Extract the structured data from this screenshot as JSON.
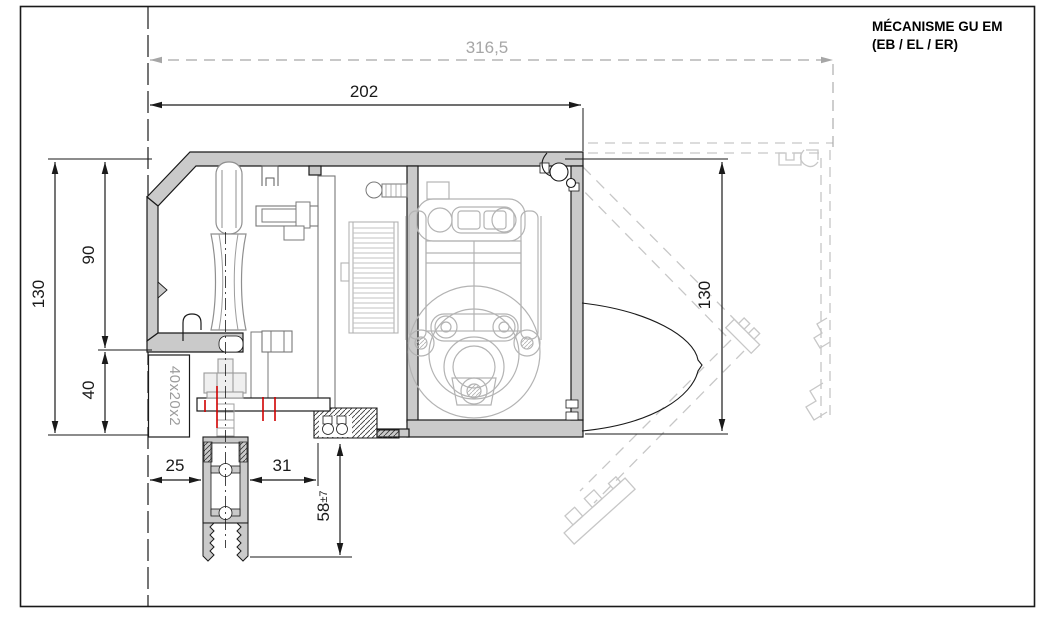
{
  "title": {
    "line1": "MÉCANISME GU EM",
    "line2": "(EB / EL / ER)"
  },
  "dimensions": {
    "overall_width": "316,5",
    "mechanism_width": "202",
    "overall_height_left": "130",
    "rail_height": "90",
    "base_height": "40",
    "overall_height_right": "130",
    "gap_left": "25",
    "gap_right": "31",
    "drop_value": "58",
    "drop_tolerance": "±7",
    "tube_label": "40x20x2"
  },
  "colors": {
    "line_black": "#1a1a1a",
    "wall_gray": "#cacaca",
    "mechanism_gray": "#b3b3b3",
    "ghost_gray": "#c7c7c7",
    "dim_gray": "#a6a6a6",
    "accent_red": "#d10000"
  }
}
